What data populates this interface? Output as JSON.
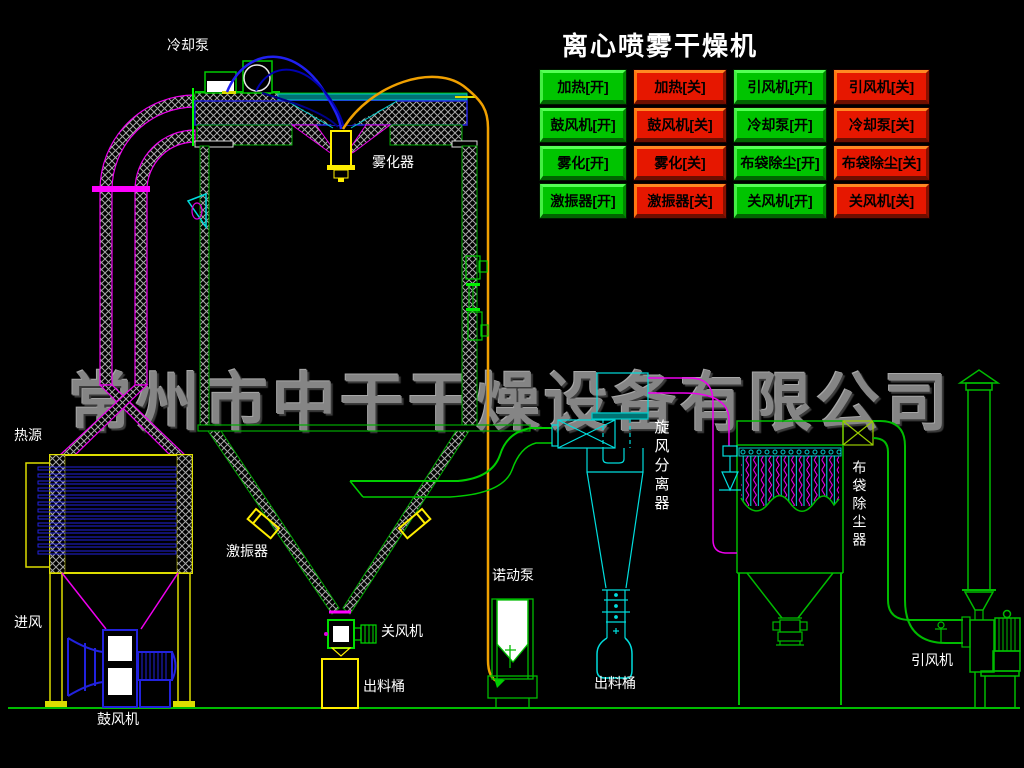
{
  "title": "离心喷雾干燥机",
  "watermark": "常州市中干干燥设备有限公司",
  "buttons": [
    {
      "label": "加热[开]",
      "state": "on"
    },
    {
      "label": "加热[关]",
      "state": "off"
    },
    {
      "label": "引风机[开]",
      "state": "on"
    },
    {
      "label": "引风机[关]",
      "state": "off"
    },
    {
      "label": "鼓风机[开]",
      "state": "on"
    },
    {
      "label": "鼓风机[关]",
      "state": "off"
    },
    {
      "label": "冷却泵[开]",
      "state": "on"
    },
    {
      "label": "冷却泵[关]",
      "state": "off"
    },
    {
      "label": "雾化[开]",
      "state": "on"
    },
    {
      "label": "雾化[关]",
      "state": "off"
    },
    {
      "label": "布袋除尘[开]",
      "state": "on"
    },
    {
      "label": "布袋除尘[关]",
      "state": "off"
    },
    {
      "label": "激振器[开]",
      "state": "on"
    },
    {
      "label": "激振器[关]",
      "state": "off"
    },
    {
      "label": "关风机[开]",
      "state": "on"
    },
    {
      "label": "关风机[关]",
      "state": "off"
    }
  ],
  "labels": {
    "cooling_pump": "冷却泵",
    "atomizer": "雾化器",
    "heat_source": "热源",
    "air_inlet": "进风",
    "blower": "鼓风机",
    "vibrator": "激振器",
    "rotary_valve": "关风机",
    "discharge_barrel_tower": "出料桶",
    "peristaltic_pump": "诺动泵",
    "discharge_barrel_cyclone": "出料桶",
    "cyclone_separator": "旋风分离器",
    "bag_filter": "布袋除尘器",
    "induced_draft_fan": "引风机"
  },
  "colors": {
    "background": "#000000",
    "button_on": "#00c400",
    "button_off": "#e61700",
    "line_green": "#00bb00",
    "line_cyan": "#00dddd",
    "line_magenta": "#ee00ee",
    "line_yellow": "#ffee00",
    "line_blue": "#2222dd",
    "line_orange": "#f0a000",
    "watermark_gray": "#858585",
    "label_text": "#ffffff"
  }
}
